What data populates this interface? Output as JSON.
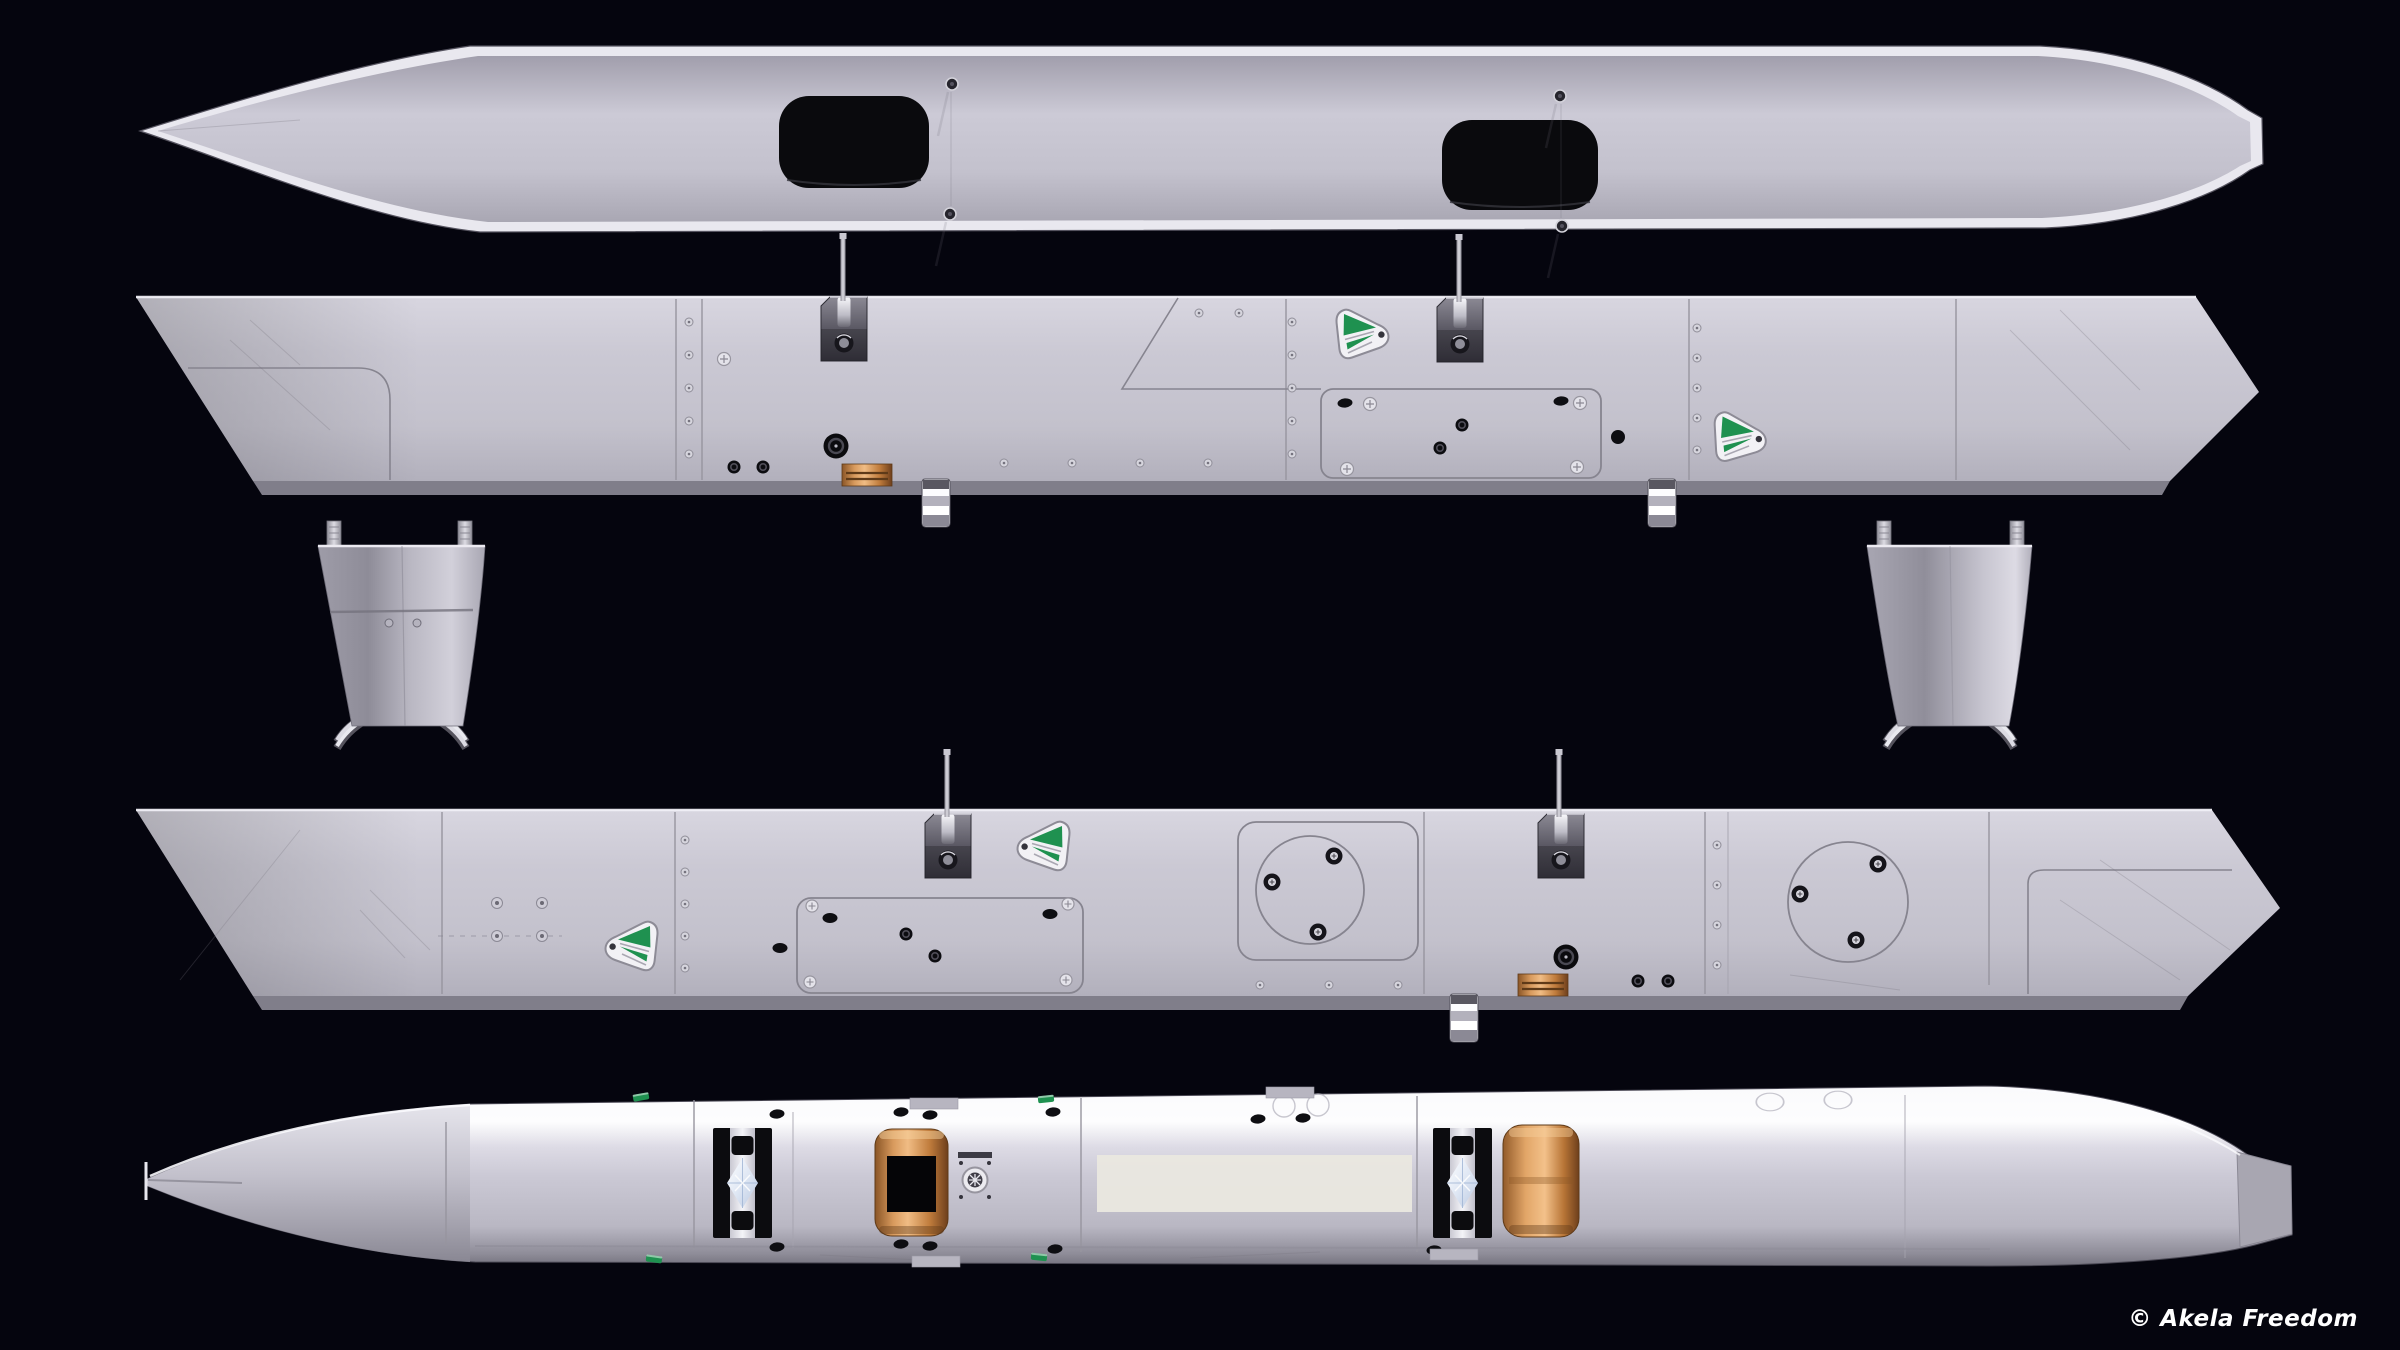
{
  "image": {
    "width": 2400,
    "height": 1350,
    "kind": "3d-render-orthographic-views",
    "subject": "grey elongated hull / float shown in five stacked views on a dark background"
  },
  "watermark": {
    "text": "© Akela Freedom",
    "color": "#ffffff"
  },
  "palette": {
    "background": "#05050e",
    "hull_rim": "#e9e8ef",
    "hull_light": "#d8d6e0",
    "hull_mid": "#c6c4cf",
    "hull_dark": "#908e9a",
    "hull_deep": "#6f6d79",
    "white_band": "#fdfdfe",
    "hatch_black": "#0a0a0d",
    "detail_black": "#0d0d11",
    "steel_dark": "#44424c",
    "steel_light": "#b9b8c2",
    "brass": "#cf8f4e",
    "brass_light": "#f0bc84",
    "brass_dark": "#8a5526",
    "green": "#1f9150",
    "decal_white": "#f2f1f5",
    "recess": "#e9e7e0",
    "seam": "#97959f",
    "band_shadow": "#807e8a"
  },
  "views": [
    {
      "id": "top-view",
      "name": "hull top view with two black hatches and four deck screws",
      "bbox": [
        140,
        18,
        2125,
        220
      ]
    },
    {
      "id": "side-view-a",
      "name": "hull side view with pin brackets, green decals, access panel, brass plate",
      "bbox": [
        135,
        297,
        2125,
        198
      ]
    },
    {
      "id": "pylon-left",
      "name": "support pylon with twin pins and crossed spring legs",
      "bbox": [
        318,
        520,
        170,
        230
      ]
    },
    {
      "id": "pylon-right",
      "name": "support pylon with twin pins and crossed spring legs",
      "bbox": [
        1867,
        520,
        168,
        230
      ]
    },
    {
      "id": "side-view-b",
      "name": "opposite hull side view with round inspection ports",
      "bbox": [
        135,
        810,
        2147,
        200
      ]
    },
    {
      "id": "bottom-view",
      "name": "hull bottom view with roller tracks, brass rollers and recess",
      "bbox": [
        140,
        1080,
        2155,
        190
      ]
    }
  ],
  "instances": [
    {
      "s": "deck-screw",
      "x": 952,
      "y": 84
    },
    {
      "s": "deck-screw",
      "x": 950,
      "y": 214
    },
    {
      "s": "deck-screw",
      "x": 1560,
      "y": 96
    },
    {
      "s": "deck-screw",
      "x": 1562,
      "y": 226
    },
    {
      "s": "rivet",
      "x": 689,
      "y": 322
    },
    {
      "s": "rivet",
      "x": 689,
      "y": 355
    },
    {
      "s": "rivet",
      "x": 689,
      "y": 388
    },
    {
      "s": "rivet",
      "x": 689,
      "y": 421
    },
    {
      "s": "rivet",
      "x": 689,
      "y": 454
    },
    {
      "s": "rivet",
      "x": 1292,
      "y": 322
    },
    {
      "s": "rivet",
      "x": 1292,
      "y": 355
    },
    {
      "s": "rivet",
      "x": 1292,
      "y": 388
    },
    {
      "s": "rivet",
      "x": 1292,
      "y": 421
    },
    {
      "s": "rivet",
      "x": 1292,
      "y": 454
    },
    {
      "s": "rivet",
      "x": 1697,
      "y": 328
    },
    {
      "s": "rivet",
      "x": 1697,
      "y": 358
    },
    {
      "s": "rivet",
      "x": 1697,
      "y": 388
    },
    {
      "s": "rivet",
      "x": 1697,
      "y": 418
    },
    {
      "s": "rivet",
      "x": 1697,
      "y": 450
    },
    {
      "s": "rivet",
      "x": 1199,
      "y": 313
    },
    {
      "s": "rivet",
      "x": 1239,
      "y": 313
    },
    {
      "s": "rivet",
      "x": 1004,
      "y": 463
    },
    {
      "s": "rivet",
      "x": 1072,
      "y": 463
    },
    {
      "s": "rivet",
      "x": 1140,
      "y": 463
    },
    {
      "s": "rivet",
      "x": 1208,
      "y": 463
    },
    {
      "s": "cross-screw",
      "x": 724,
      "y": 359
    },
    {
      "s": "cross-screw",
      "x": 1370,
      "y": 404
    },
    {
      "s": "cross-screw",
      "x": 1580,
      "y": 403
    },
    {
      "s": "cross-screw",
      "x": 1347,
      "y": 469
    },
    {
      "s": "cross-screw",
      "x": 1577,
      "y": 467
    },
    {
      "s": "grommet-lg",
      "x": 836,
      "y": 446
    },
    {
      "s": "grommet-sm",
      "x": 1462,
      "y": 425
    },
    {
      "s": "grommet-sm",
      "x": 1440,
      "y": 448
    },
    {
      "s": "grommet-sm",
      "x": 734,
      "y": 467
    },
    {
      "s": "grommet-sm",
      "x": 763,
      "y": 467
    },
    {
      "s": "black-oval",
      "x": 1345,
      "y": 403
    },
    {
      "s": "black-oval",
      "x": 1561,
      "y": 401
    },
    {
      "s": "black-dot",
      "x": 1618,
      "y": 437
    },
    {
      "s": "decal-fan",
      "x": 1334,
      "y": 306
    },
    {
      "s": "decal-fan",
      "x": 1713,
      "y": 408,
      "t": " rotate(3)"
    },
    {
      "s": "bracket-clip",
      "x": 821,
      "y": 297
    },
    {
      "s": "bracket-clip",
      "x": 1437,
      "y": 298
    },
    {
      "s": "pin-rod",
      "x": 843,
      "y": 233
    },
    {
      "s": "pin-rod",
      "x": 1459,
      "y": 234
    },
    {
      "s": "brass-plate",
      "x": 842,
      "y": 464
    },
    {
      "s": "drain-plug",
      "x": 922,
      "y": 479
    },
    {
      "s": "drain-plug",
      "x": 1648,
      "y": 479
    },
    {
      "s": "rivet",
      "x": 685,
      "y": 840
    },
    {
      "s": "rivet",
      "x": 685,
      "y": 872
    },
    {
      "s": "rivet",
      "x": 685,
      "y": 904
    },
    {
      "s": "rivet",
      "x": 685,
      "y": 936
    },
    {
      "s": "rivet",
      "x": 685,
      "y": 968
    },
    {
      "s": "rivet",
      "x": 1717,
      "y": 845
    },
    {
      "s": "rivet",
      "x": 1717,
      "y": 885
    },
    {
      "s": "rivet",
      "x": 1717,
      "y": 925
    },
    {
      "s": "rivet",
      "x": 1717,
      "y": 965
    },
    {
      "s": "rivet",
      "x": 1260,
      "y": 985
    },
    {
      "s": "rivet",
      "x": 1329,
      "y": 985
    },
    {
      "s": "rivet",
      "x": 1398,
      "y": 985
    },
    {
      "s": "screw-washer",
      "x": 497,
      "y": 903
    },
    {
      "s": "screw-washer",
      "x": 542,
      "y": 903
    },
    {
      "s": "screw-washer",
      "x": 497,
      "y": 936
    },
    {
      "s": "screw-washer",
      "x": 542,
      "y": 936
    },
    {
      "s": "decal-fan",
      "x": 660,
      "y": 918,
      "t": " scale(-1,1)"
    },
    {
      "s": "decal-fan",
      "x": 1072,
      "y": 818,
      "t": " scale(-1,1)"
    },
    {
      "s": "bracket-clip",
      "x": 925,
      "y": 814
    },
    {
      "s": "bracket-clip",
      "x": 1538,
      "y": 814
    },
    {
      "s": "pin-rod",
      "x": 947,
      "y": 749
    },
    {
      "s": "pin-rod",
      "x": 1559,
      "y": 749
    },
    {
      "s": "ring-screw",
      "x": 1334,
      "y": 856
    },
    {
      "s": "ring-screw",
      "x": 1272,
      "y": 882
    },
    {
      "s": "ring-screw",
      "x": 1318,
      "y": 932
    },
    {
      "s": "ring-screw",
      "x": 1878,
      "y": 864
    },
    {
      "s": "ring-screw",
      "x": 1800,
      "y": 894
    },
    {
      "s": "ring-screw",
      "x": 1856,
      "y": 940
    },
    {
      "s": "grommet-lg",
      "x": 1566,
      "y": 957
    },
    {
      "s": "brass-plate",
      "x": 1518,
      "y": 974
    },
    {
      "s": "grommet-sm",
      "x": 1638,
      "y": 981
    },
    {
      "s": "grommet-sm",
      "x": 1668,
      "y": 981
    },
    {
      "s": "drain-plug",
      "x": 1450,
      "y": 994
    },
    {
      "s": "roller-track",
      "x": 713,
      "y": 1128
    },
    {
      "s": "roller-track",
      "x": 1433,
      "y": 1128
    },
    {
      "s": "brass-roller-window",
      "x": 875,
      "y": 1129
    },
    {
      "s": "brass-roller-plain",
      "x": 1503,
      "y": 1125
    },
    {
      "s": "connector-ring",
      "x": 958,
      "y": 1152
    },
    {
      "s": "green-mini",
      "x": 641,
      "y": 1097,
      "t": " rotate(-10)"
    },
    {
      "s": "green-mini",
      "x": 1046,
      "y": 1099,
      "t": " rotate(-6)"
    },
    {
      "s": "green-mini",
      "x": 654,
      "y": 1259,
      "t": " rotate(8)"
    },
    {
      "s": "green-mini",
      "x": 1039,
      "y": 1257,
      "t": " rotate(6)"
    },
    {
      "s": "black-oval",
      "x": 777,
      "y": 1114
    },
    {
      "s": "black-oval",
      "x": 901,
      "y": 1112
    },
    {
      "s": "black-oval",
      "x": 930,
      "y": 1115
    },
    {
      "s": "black-oval",
      "x": 1053,
      "y": 1112
    },
    {
      "s": "black-oval",
      "x": 1258,
      "y": 1119
    },
    {
      "s": "black-oval",
      "x": 1303,
      "y": 1118
    },
    {
      "s": "black-oval",
      "x": 777,
      "y": 1247
    },
    {
      "s": "black-oval",
      "x": 901,
      "y": 1244
    },
    {
      "s": "black-oval",
      "x": 930,
      "y": 1246
    },
    {
      "s": "black-oval",
      "x": 1055,
      "y": 1249
    },
    {
      "s": "black-oval",
      "x": 1434,
      "y": 1250
    },
    {
      "s": "faint-circle",
      "x": 1284,
      "y": 1106
    },
    {
      "s": "faint-circle",
      "x": 1318,
      "y": 1105
    },
    {
      "s": "faint-circle",
      "x": 1770,
      "y": 1102,
      "t": " scale(1.25,0.8)"
    },
    {
      "s": "faint-circle",
      "x": 1838,
      "y": 1100,
      "t": " scale(1.25,0.8)"
    },
    {
      "s": "gray-tab",
      "x": 910,
      "y": 1098
    },
    {
      "s": "gray-tab",
      "x": 1266,
      "y": 1087
    },
    {
      "s": "gray-tab",
      "x": 912,
      "y": 1256
    },
    {
      "s": "gray-tab",
      "x": 1430,
      "y": 1249
    }
  ]
}
